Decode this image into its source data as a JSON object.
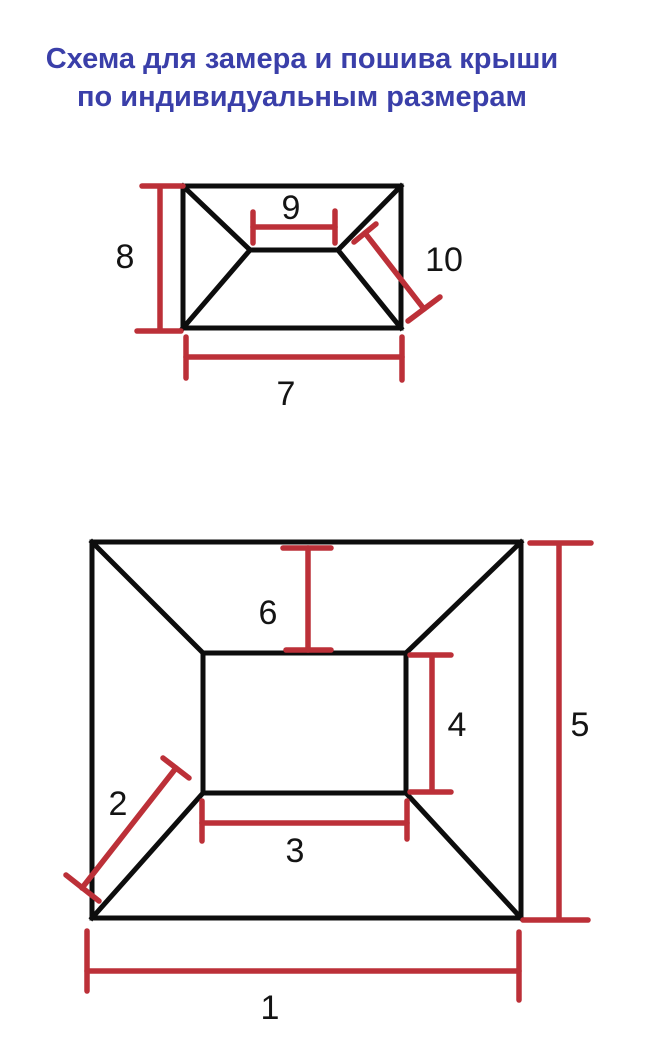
{
  "title": {
    "line1": "Схема для замера и пошива крыши",
    "line2": "по индивидуальным размерам"
  },
  "colors": {
    "title": "#3a3fa9",
    "outline": "#0d0d0d",
    "dimension": "#bc3038",
    "background": "#ffffff"
  },
  "top_diagram": {
    "description": "hip-roof-plan-small",
    "labels": {
      "base_width": "7",
      "side_height": "8",
      "ridge_length": "9",
      "hip_length": "10"
    }
  },
  "bottom_diagram": {
    "description": "flat-top-roof-plan-large",
    "labels": {
      "base_width": "1",
      "hip_length": "2",
      "top_width": "3",
      "top_height": "4",
      "base_height": "5",
      "slope_height": "6"
    }
  }
}
